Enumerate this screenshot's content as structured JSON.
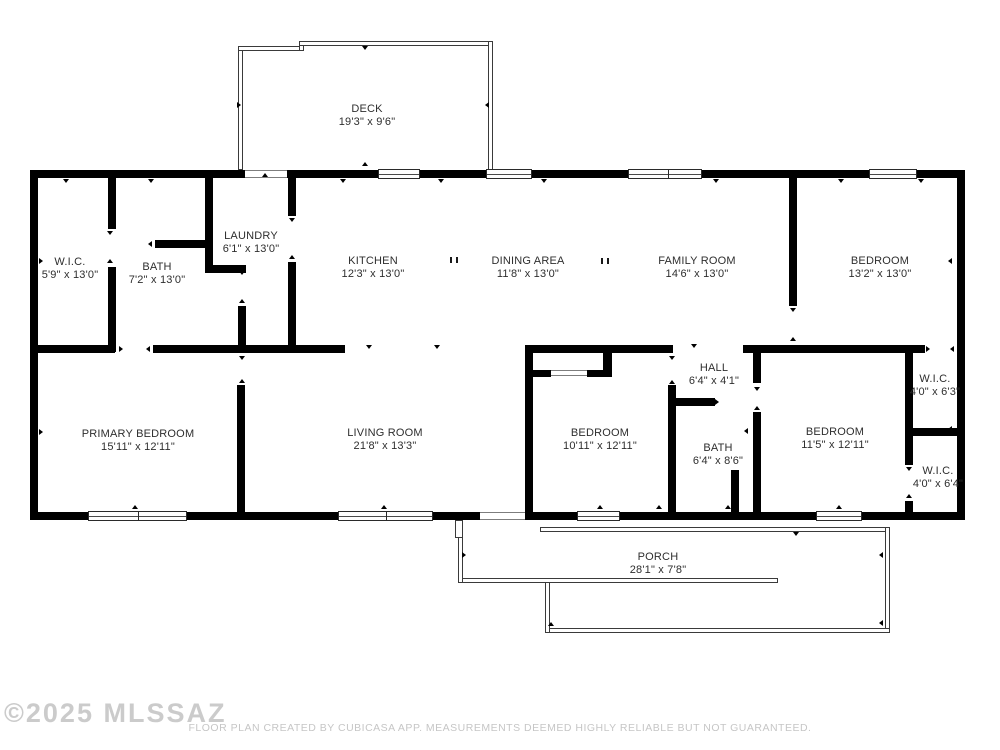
{
  "watermark": "©2025 MLSSAZ",
  "disclaimer": "FLOOR PLAN CREATED BY CUBICASA APP. MEASUREMENTS DEEMED HIGHLY RELIABLE BUT NOT GUARANTEED.",
  "colors": {
    "wall": "#000000",
    "label_text": "#2e2e2e",
    "muted_text": "#c6c6c6"
  },
  "rooms": {
    "deck": {
      "name": "DECK",
      "dims": "19'3\" x 9'6\""
    },
    "wic_left": {
      "name": "W.I.C.",
      "dims": "5'9\" x 13'0\""
    },
    "bath_left": {
      "name": "BATH",
      "dims": "7'2\" x 13'0\""
    },
    "laundry": {
      "name": "LAUNDRY",
      "dims": "6'1\" x 13'0\""
    },
    "kitchen": {
      "name": "KITCHEN",
      "dims": "12'3\" x 13'0\""
    },
    "dining": {
      "name": "DINING AREA",
      "dims": "11'8\" x 13'0\""
    },
    "family": {
      "name": "FAMILY ROOM",
      "dims": "14'6\" x 13'0\""
    },
    "bedroom_ne": {
      "name": "BEDROOM",
      "dims": "13'2\" x 13'0\""
    },
    "primary": {
      "name": "PRIMARY BEDROOM",
      "dims": "15'11\" x 12'11\""
    },
    "living": {
      "name": "LIVING ROOM",
      "dims": "21'8\" x 13'3\""
    },
    "bedroom_mid": {
      "name": "BEDROOM",
      "dims": "10'11\" x 12'11\""
    },
    "hall": {
      "name": "HALL",
      "dims": "6'4\" x 4'1\""
    },
    "bath_mid": {
      "name": "BATH",
      "dims": "6'4\" x 8'6\""
    },
    "bedroom_se": {
      "name": "BEDROOM",
      "dims": "11'5\" x 12'11\""
    },
    "wic_upper": {
      "name": "W.I.C.",
      "dims": "4'0\" x 6'3\""
    },
    "wic_lower": {
      "name": "W.I.C.",
      "dims": "4'0\" x 6'4\""
    },
    "porch": {
      "name": "PORCH",
      "dims": "28'1\" x 7'8\""
    }
  }
}
